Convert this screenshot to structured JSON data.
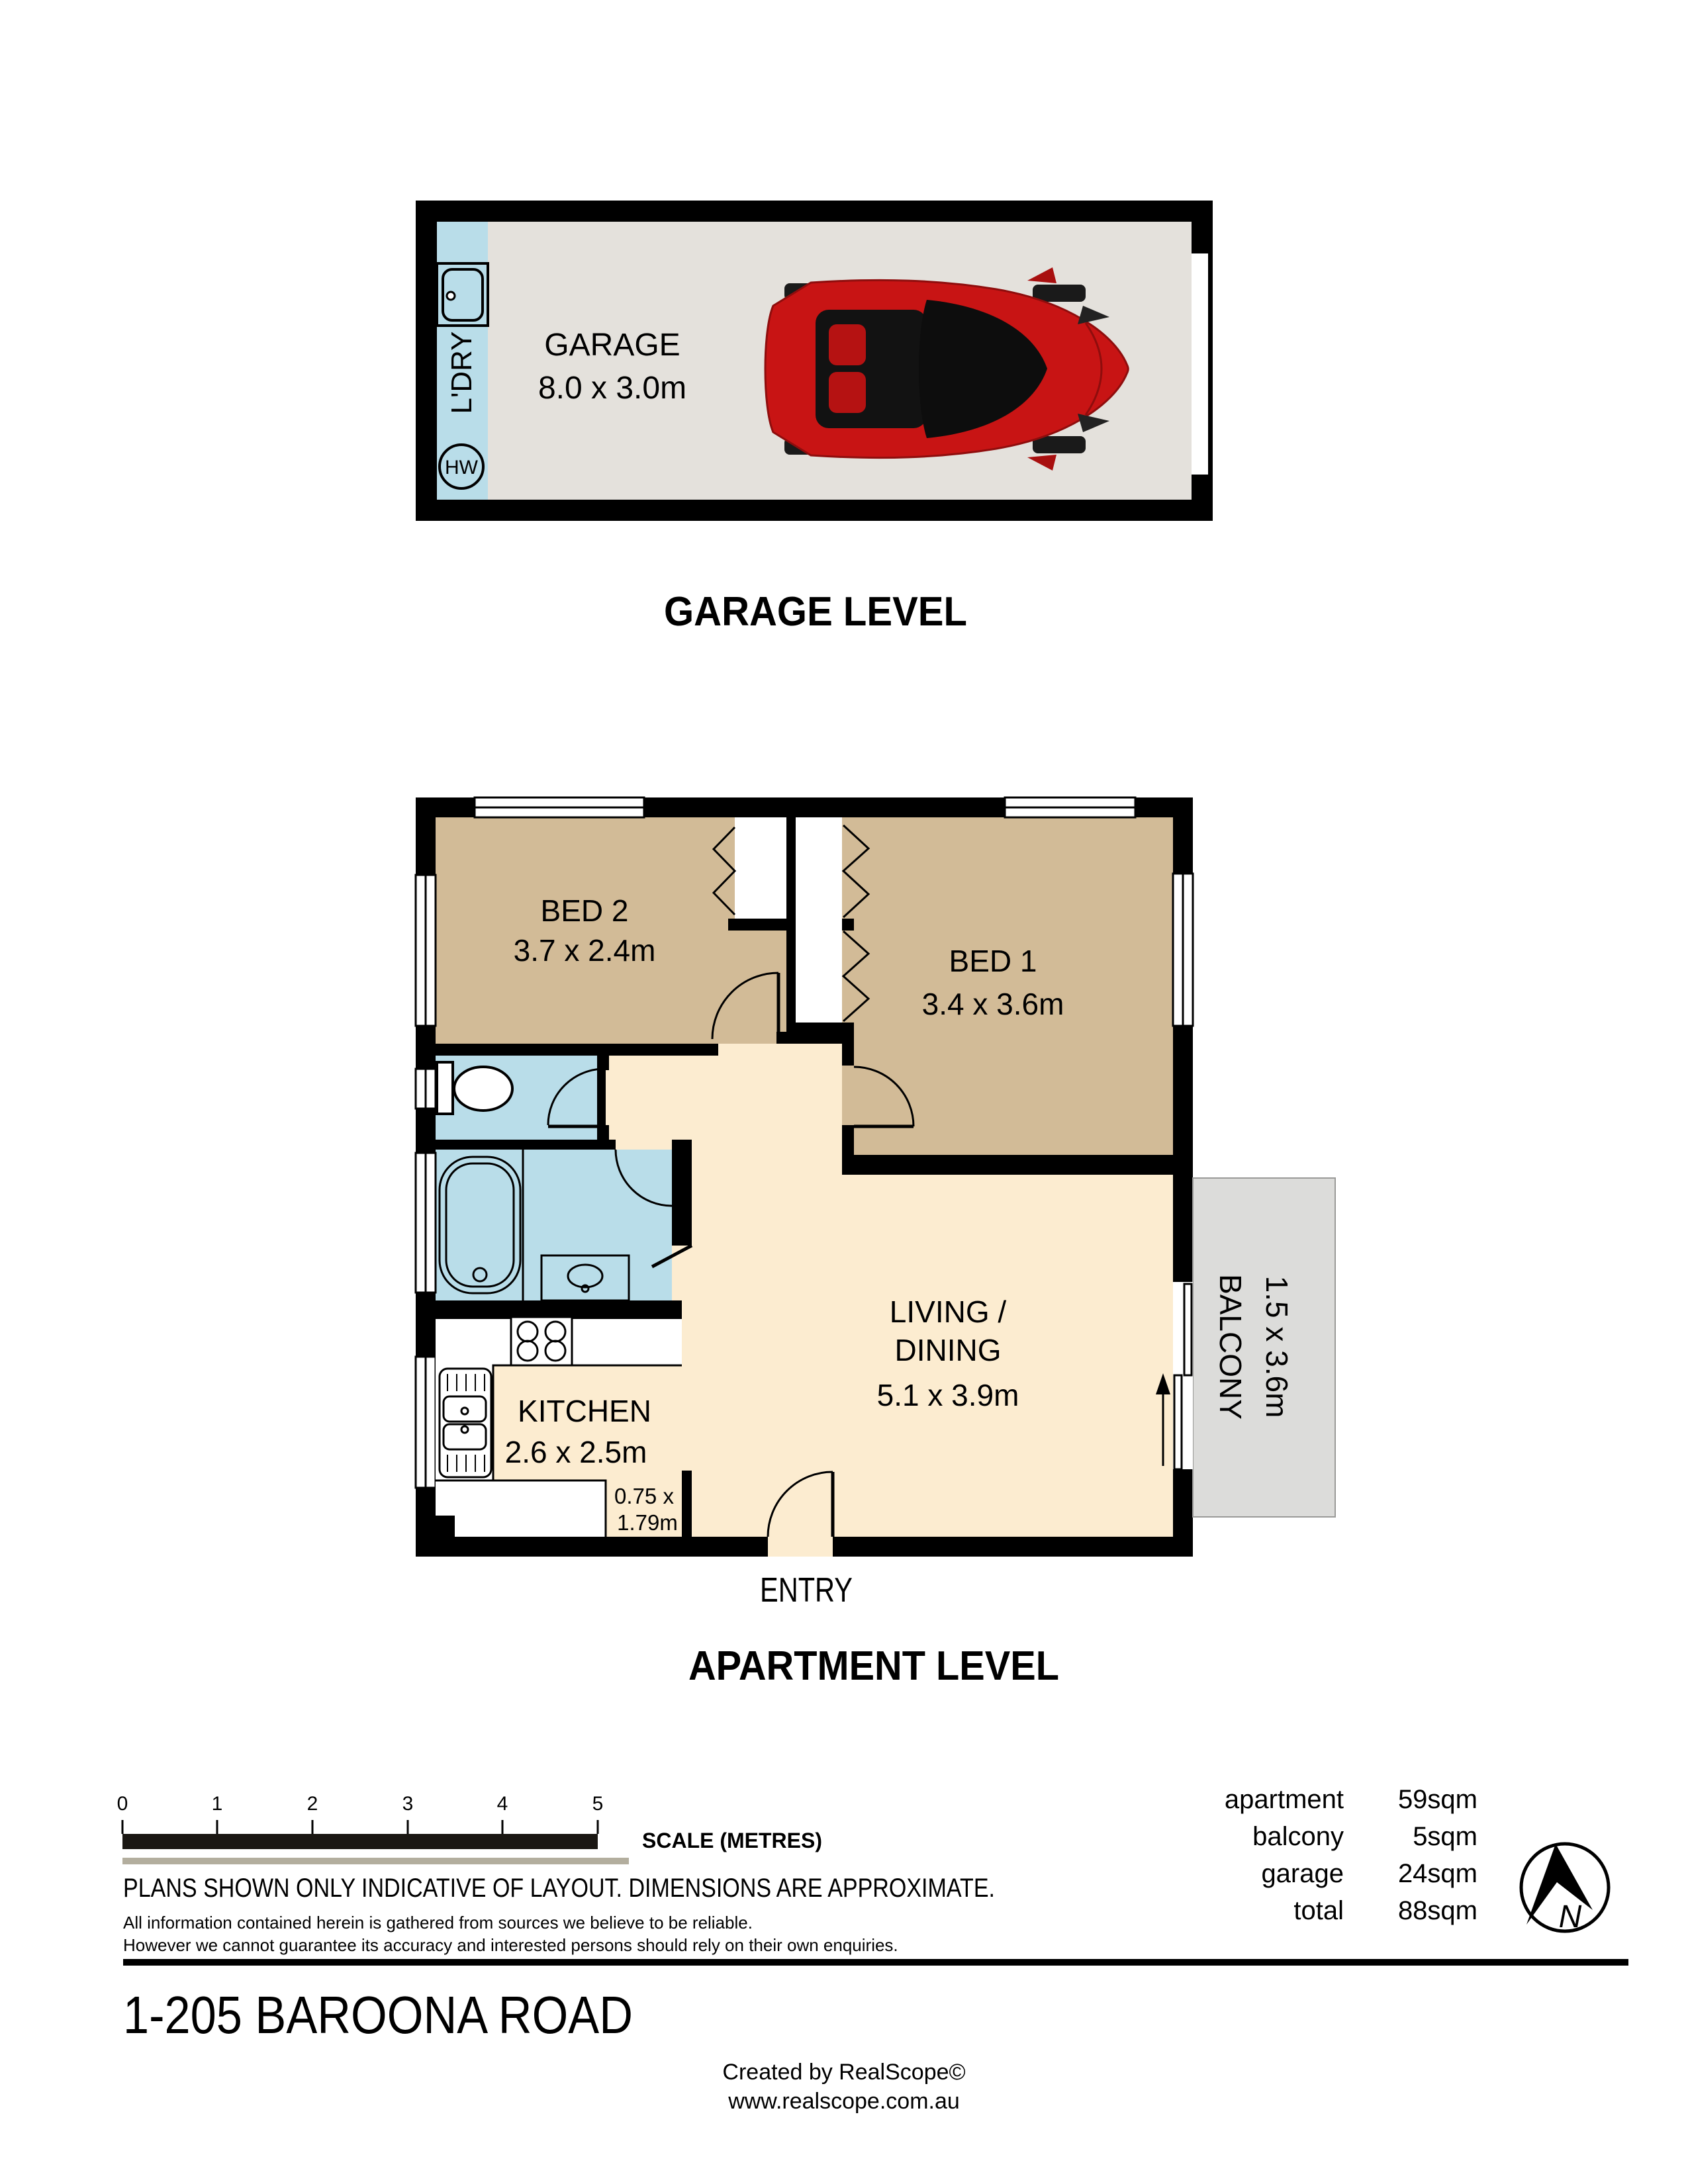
{
  "colors": {
    "wall": "#000000",
    "bedroom_fill": "#d2bb97",
    "living_fill": "#fcecd0",
    "wet_area_fill": "#b9dde9",
    "garage_floor": "#e4e1dc",
    "balcony_fill": "#dcdcda",
    "car_red": "#c81414",
    "scale_bar_secondary": "#b3ae9e"
  },
  "garage_level": {
    "title": "GARAGE LEVEL",
    "room_name": "GARAGE",
    "room_dims": "8.0 x 3.0m",
    "laundry_label": "L'DRY",
    "hot_water_label": "HW"
  },
  "apartment_level": {
    "title": "APARTMENT LEVEL",
    "entry_label": "ENTRY",
    "rooms": {
      "bed2": {
        "name": "BED 2",
        "dims": "3.7 x 2.4m"
      },
      "bed1": {
        "name": "BED 1",
        "dims": "3.4 x 3.6m"
      },
      "living": {
        "name_line1": "LIVING /",
        "name_line2": "DINING",
        "dims": "5.1 x 3.9m"
      },
      "kitchen": {
        "name": "KITCHEN",
        "dims": "2.6 x 2.5m"
      },
      "balcony": {
        "name": "BALCONY",
        "dims": "1.5 x 3.6m"
      },
      "store": {
        "dims_line1": "0.75 x",
        "dims_line2": "1.79m"
      }
    }
  },
  "scale_bar": {
    "ticks": [
      "0",
      "1",
      "2",
      "3",
      "4",
      "5"
    ],
    "label": "SCALE (METRES)"
  },
  "disclaimer": {
    "line1": "PLANS SHOWN ONLY INDICATIVE OF LAYOUT.  DIMENSIONS ARE APPROXIMATE.",
    "line2": "All information contained herein is gathered from sources we believe to be reliable.",
    "line3": "However we cannot guarantee its accuracy and interested persons should rely on their own enquiries."
  },
  "areas": {
    "rows": [
      {
        "label": "apartment",
        "value": "59sqm"
      },
      {
        "label": "balcony",
        "value": "5sqm"
      },
      {
        "label": "garage",
        "value": "24sqm"
      },
      {
        "label": "total",
        "value": "88sqm"
      }
    ]
  },
  "compass": {
    "label": "N"
  },
  "footer": {
    "address": "1-205 BAROONA ROAD",
    "credit": "Created by RealScope©",
    "website": "www.realscope.com.au"
  }
}
